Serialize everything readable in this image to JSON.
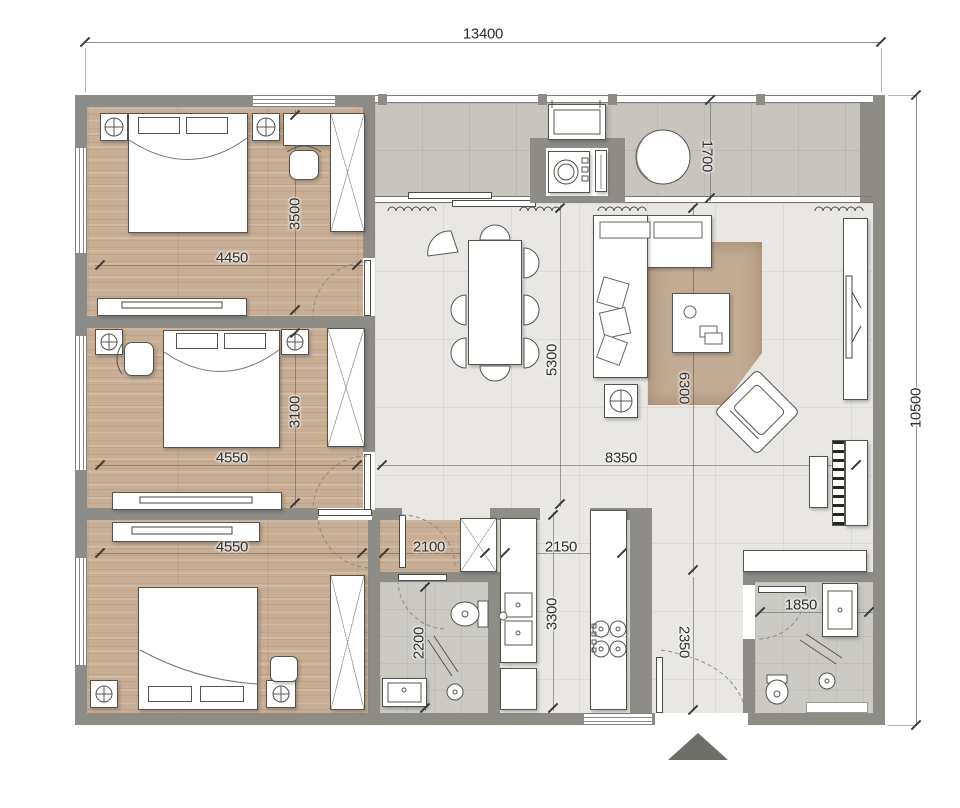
{
  "meta": {
    "type": "apartment-floor-plan"
  },
  "dimensions": {
    "overall_width": "13400",
    "overall_height": "10500",
    "bedroom1_width": "4450",
    "bedroom1_depth": "3500",
    "bedroom2_width": "4550",
    "bedroom2_depth": "3100",
    "bedroom3_width": "4550",
    "hallway_width": "2100",
    "kitchen_width": "2150",
    "kitchen_depth": "3300",
    "bathroom1_depth": "2200",
    "bathroom2_width": "1850",
    "living_width": "8350",
    "dining_zone_depth": "5300",
    "living_zone_depth": "6300",
    "balcony_width": "1700",
    "entry_depth": "2350"
  },
  "colors": {
    "wall": "#8d8c86",
    "wood": "#c7ae94",
    "tile": "#e8e7e3",
    "balcony": "#c7c5be",
    "bathf": "#cbcac5",
    "rug": "#c2ab93",
    "marker": "#6e6d67"
  },
  "icons": [
    "bed",
    "pillow",
    "wardrobe",
    "nightstand-lamp",
    "desk",
    "desk-chair",
    "tv-console",
    "dining-table",
    "dining-chair",
    "lounge-chair",
    "sofa",
    "sofa-pillow",
    "coffee-table",
    "armchair",
    "rug",
    "side-table-lamp",
    "piano",
    "piano-bench",
    "tv-cabinet",
    "washing-machine",
    "shelf",
    "ac-unit",
    "balcony-table",
    "kitchen-counter",
    "kitchen-sink",
    "stove",
    "toilet",
    "shower",
    "bathroom-sink",
    "entry-arrow",
    "door-leaf",
    "door-arc",
    "window",
    "curtain",
    "railing"
  ]
}
